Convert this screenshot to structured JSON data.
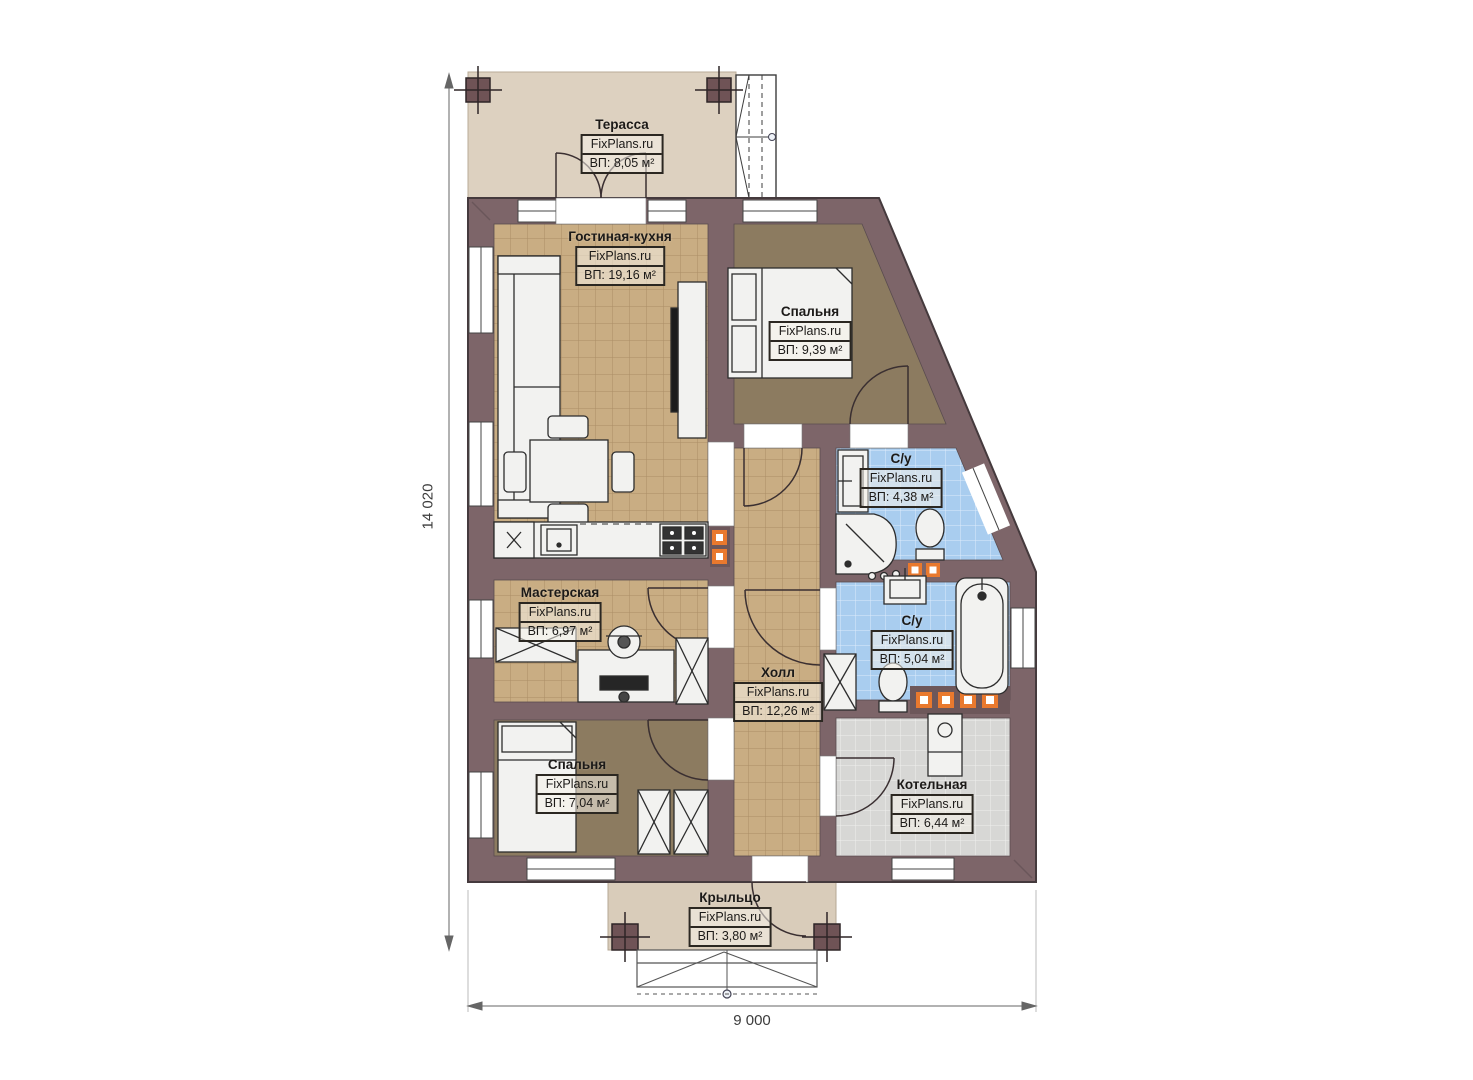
{
  "plan": {
    "brand": "FixPlans.ru",
    "dimensions": {
      "height": "14 020",
      "width": "9 000"
    },
    "rooms": [
      {
        "name": "Терасса",
        "brand": "FixPlans.ru",
        "area": "ВП: 8,05 м²"
      },
      {
        "name": "Гостиная-кухня",
        "brand": "FixPlans.ru",
        "area": "ВП: 19,16 м²"
      },
      {
        "name": "Спальня",
        "brand": "FixPlans.ru",
        "area": "ВП: 9,39 м²"
      },
      {
        "name": "С/у",
        "brand": "FixPlans.ru",
        "area": "ВП: 4,38 м²"
      },
      {
        "name": "Мастерская",
        "brand": "FixPlans.ru",
        "area": "ВП: 6,97 м²"
      },
      {
        "name": "Холл",
        "brand": "FixPlans.ru",
        "area": "ВП: 12,26 м²"
      },
      {
        "name": "С/у",
        "brand": "FixPlans.ru",
        "area": "ВП: 5,04 м²"
      },
      {
        "name": "Спальня",
        "brand": "FixPlans.ru",
        "area": "ВП: 7,04 м²"
      },
      {
        "name": "Котельная",
        "brand": "FixPlans.ru",
        "area": "ВП: 6,44 м²"
      },
      {
        "name": "Крыльцо",
        "brand": "FixPlans.ru",
        "area": "ВП: 3,80 м²"
      }
    ],
    "colors": {
      "wall": "#7d6569",
      "tile_tan": "#c9ad83",
      "tile_blue": "#a9cdef",
      "tile_gray": "#d7d7d5",
      "bedroom_floor": "#8c7b60",
      "terrace_floor": "#ddd1c0",
      "accent_orange": "#e9792e"
    }
  }
}
